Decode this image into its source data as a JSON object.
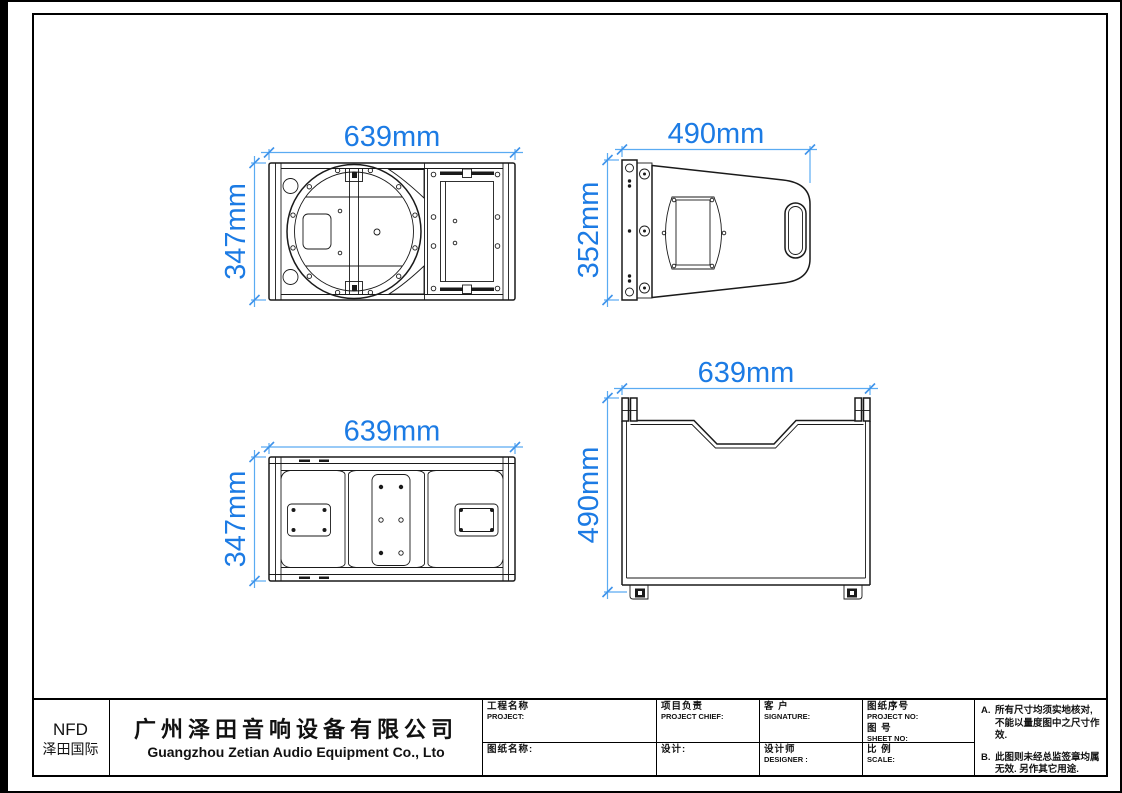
{
  "colors": {
    "line": "#1a1a1a",
    "dim_line": "#5aabf2",
    "dim_text": "#1c7be4",
    "background": "#ffffff"
  },
  "views": {
    "front": {
      "title": "front-view",
      "width": "639mm",
      "height": "347mm"
    },
    "side": {
      "title": "side-view",
      "width": "490mm",
      "height": "352mm"
    },
    "rear": {
      "title": "rear-view",
      "width": "639mm",
      "height": "347mm"
    },
    "top": {
      "title": "top-view",
      "width": "639mm",
      "height": "490mm"
    }
  },
  "title_block": {
    "brand": {
      "code": "NFD",
      "name_cn": "泽田国际"
    },
    "company": {
      "name_cn": "广州泽田音响设备有限公司",
      "name_en": "Guangzhou Zetian Audio Equipment Co., Lto"
    },
    "cells": {
      "project": {
        "cn": "工程名称",
        "en": "PROJECT:"
      },
      "drawing_name": {
        "cn": "图纸名称:"
      },
      "chief": {
        "cn": "项目负责",
        "en": "PROJECT CHIEF:"
      },
      "design": {
        "cn": "设计:"
      },
      "customer": {
        "cn": "客 户",
        "en": "SIGNATURE:"
      },
      "designer": {
        "cn": "设计师",
        "en": "DESIGNER :"
      },
      "project_no": {
        "cn": "图纸序号",
        "en": "PROJECT NO:"
      },
      "sheet_no": {
        "cn": "图  号",
        "en": "SHEET  NO:"
      },
      "scale": {
        "cn": "比  例",
        "en": "SCALE:"
      }
    },
    "notes": [
      {
        "id": "A.",
        "text": "所有尺寸均须实地核对, 不能以量度图中之尺寸作效."
      },
      {
        "id": "B.",
        "text": "此图则未经总监签章均属无效. 另作其它用途."
      }
    ]
  }
}
